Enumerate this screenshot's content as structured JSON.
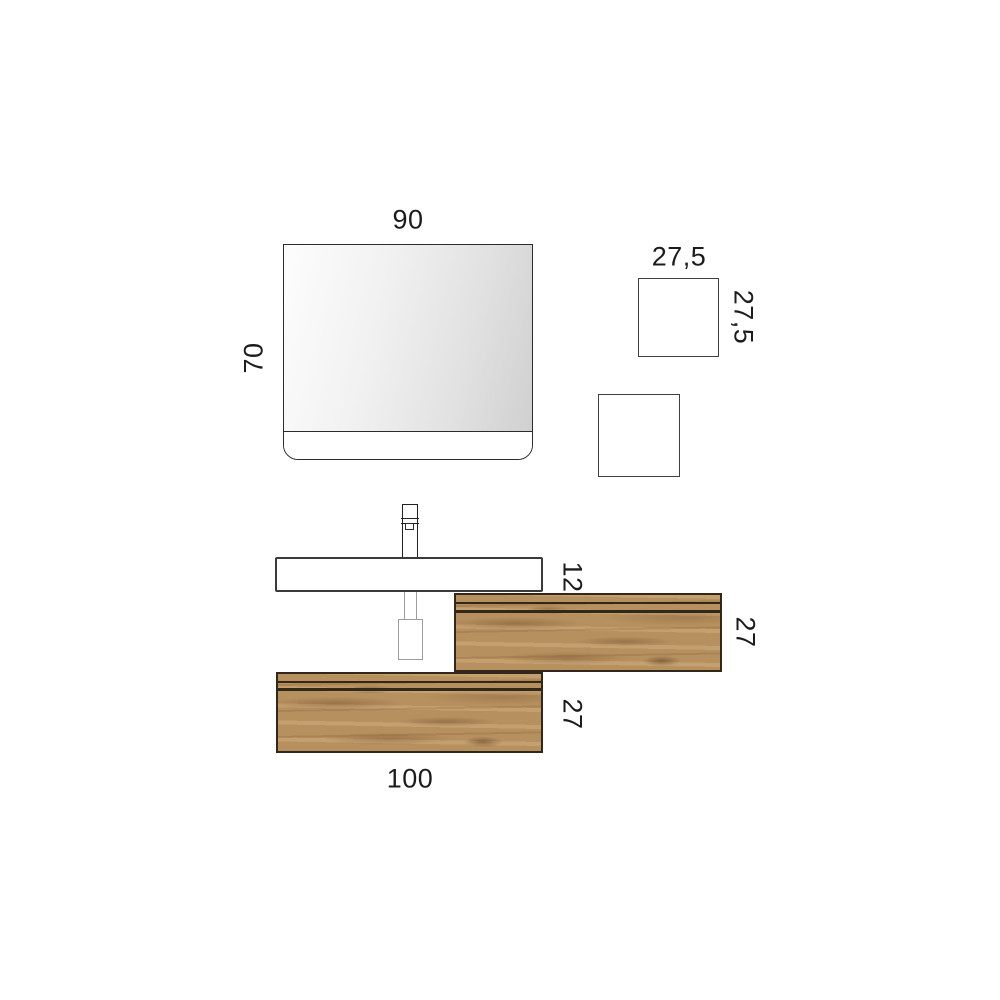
{
  "labels": {
    "mirror_width": "90",
    "mirror_height": "70",
    "cube_width": "27,5",
    "cube_height": "27,5",
    "washbasin_height": "12",
    "upper_cabinet_height": "27",
    "lower_cabinet_height": "27",
    "lower_cabinet_width": "100"
  },
  "colors": {
    "background": "#ffffff",
    "outline": "#2b2b2b",
    "text": "#1c1c1c",
    "mirror_gradient_start": "#fdfdfd",
    "mirror_gradient_end": "#d0d0d0",
    "pipe_outline": "#9c9c9c",
    "wood_base": "#b7905f",
    "wood_dark": "#6e4c2a",
    "wood_light": "#cfa97c",
    "cabinet_edge": "#32281a"
  }
}
